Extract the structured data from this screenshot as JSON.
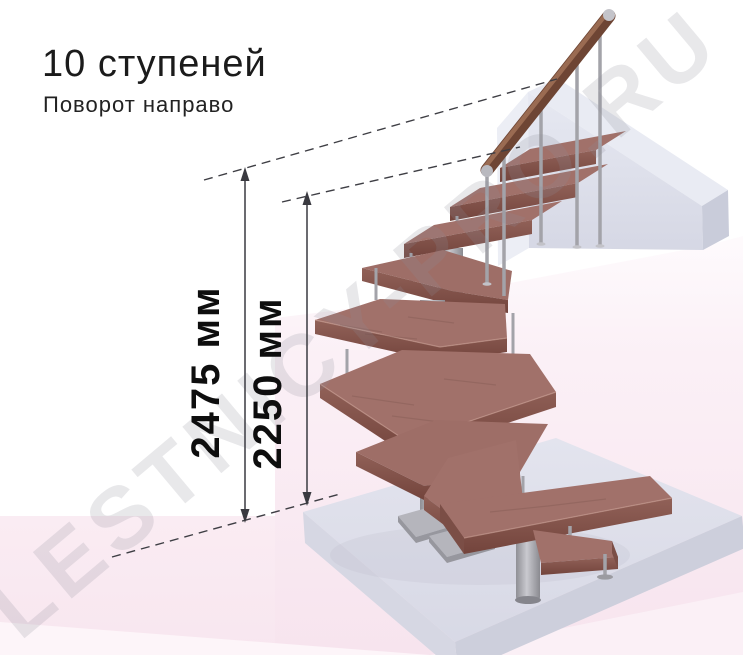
{
  "title": "10 ступеней",
  "subtitle": "Поворот направо",
  "dimensions": [
    {
      "label": "2475 мм"
    },
    {
      "label": "2250 мм"
    }
  ],
  "watermark": "LESTNICY-PRO.RU",
  "scene": {
    "steps_count": 10,
    "turn_direction": "направо",
    "parts": [
      "wooden-winder-treads",
      "metal-center-columns",
      "metal-balusters",
      "wooden-handrail",
      "upper-landing-beam",
      "floor-slab",
      "base-plates"
    ],
    "colors": {
      "wood_top": "#a1716a",
      "wood_front": "#8a5a52",
      "wood_side": "#7b4e46",
      "handrail": "#6e4534",
      "metal": "#a8a8ae",
      "landing_top": "#e9ebf3",
      "floor_top": "#dddee9",
      "background_pink": "#f8e6ef",
      "dimension_line": "#46464c",
      "text": "#1b1b1b"
    }
  }
}
